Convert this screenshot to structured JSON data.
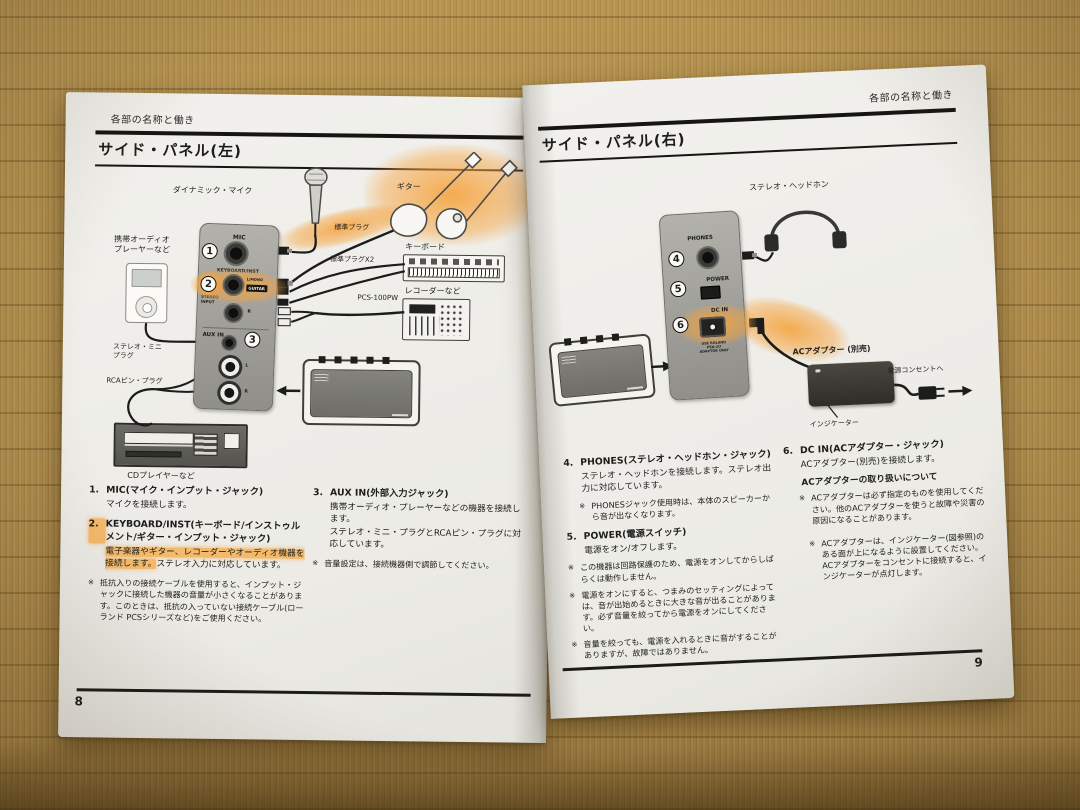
{
  "scene": {
    "accent_orange": "#f0a14b",
    "paper_color": "#f0efeb",
    "panel_gray": "#a6a5a1"
  },
  "glyphs": {
    "note_mark": "※"
  },
  "left_page": {
    "header": "各部の名称と働き",
    "title": "サイド・パネル(左)",
    "page_number": "8",
    "diagram": {
      "dynamic_mic_label": "ダイナミック・マイク",
      "guitar_label": "ギター",
      "plug_label": "標準プラグ",
      "plug_x2_label": "標準プラグX2",
      "keyboard_label": "キーボード",
      "recorder_label": "レコーダーなど",
      "pcs_cable_label": "PCS-100PW",
      "portable_audio_label": "携帯オーディオ\nプレーヤーなど",
      "stereo_mini_label": "ステレオ・ミニ\nプラグ",
      "rca_pin_label": "RCAピン・プラグ",
      "cd_player_label": "CDプレイヤーなど",
      "panel": {
        "mic": "MIC",
        "keyboard_inst": "KEYBOARD/INST",
        "l_mono": "L/MONO",
        "guitar_tag": "GUITAR",
        "stereo_input": "STEREO\nINPUT",
        "r": "R",
        "aux_in": "AUX IN",
        "l": "L",
        "num_1": "1",
        "num_2": "2",
        "num_3": "3"
      }
    },
    "sections": {
      "s1": {
        "num": "1.",
        "title": "MIC(マイク・インプット・ジャック)",
        "body": "マイクを接続します。"
      },
      "s2": {
        "num": "2.",
        "title": "KEYBOARD/INST(キーボード/インストゥルメント/ギター・インプット・ジャック)",
        "body_highlight": "電子楽器やギター、レコーダーやオーディオ機器を接続します。",
        "body_rest": "ステレオ入力に対応しています。",
        "note": "抵抗入りの接続ケーブルを使用すると、インプット・ジャックに接続した機器の音量が小さくなることがあります。このときは、抵抗の入っていない接続ケーブル(ローランド PCSシリーズなど)をご使用ください。"
      },
      "s3": {
        "num": "3.",
        "title": "AUX IN(外部入力ジャック)",
        "body": "携帯オーディオ・プレーヤーなどの機器を接続します。\nステレオ・ミニ・プラグとRCAピン・プラグに対応しています。",
        "note": "音量設定は、接続機器側で調節してください。"
      }
    }
  },
  "right_page": {
    "header": "各部の名称と働き",
    "title": "サイド・パネル(右)",
    "page_number": "9",
    "diagram": {
      "headphones_label": "ステレオ・ヘッドホン",
      "ac_adapter_label": "ACアダプター (別売)",
      "indicator_label": "インジケーター",
      "outlet_label": "電源コンセントへ",
      "panel": {
        "phones": "PHONES",
        "power": "POWER",
        "dc_in": "DC IN",
        "adaptor_note": "USE ROLAND\nPSA-1U\nADAPTOR ONLY",
        "num_4": "4",
        "num_5": "5",
        "num_6": "6"
      }
    },
    "sections": {
      "s4": {
        "num": "4.",
        "title": "PHONES(ステレオ・ヘッドホン・ジャック)",
        "body": "ステレオ・ヘッドホンを接続します。ステレオ出力に対応しています。",
        "note": "PHONESジャック使用時は、本体のスピーカーから音が出なくなります。"
      },
      "s5": {
        "num": "5.",
        "title": "POWER(電源スイッチ)",
        "body": "電源をオン/オフします。",
        "note1": "この機器は回路保護のため、電源をオンしてからしばらくは動作しません。",
        "note2": "電源をオンにすると、つまみのセッティングによっては、音が出始めるときに大きな音が出ることがあります。必ず音量を絞ってから電源をオンにしてください。",
        "note3": "音量を絞っても、電源を入れるときに音がすることがありますが、故障ではありません。"
      },
      "s6": {
        "num": "6.",
        "title": "DC IN(ACアダプター・ジャック)",
        "body": "ACアダプター(別売)を接続します。",
        "subhead": "ACアダプターの取り扱いについて",
        "note1": "ACアダプターは必ず指定のものを使用してください。他のACアダプターを使うと故障や災害の原因になることがあります。",
        "note2": "ACアダプターは、インジケーター(図参照)のある面が上になるように設置してください。ACアダプターをコンセントに接続すると、インジケーターが点灯します。"
      }
    }
  }
}
